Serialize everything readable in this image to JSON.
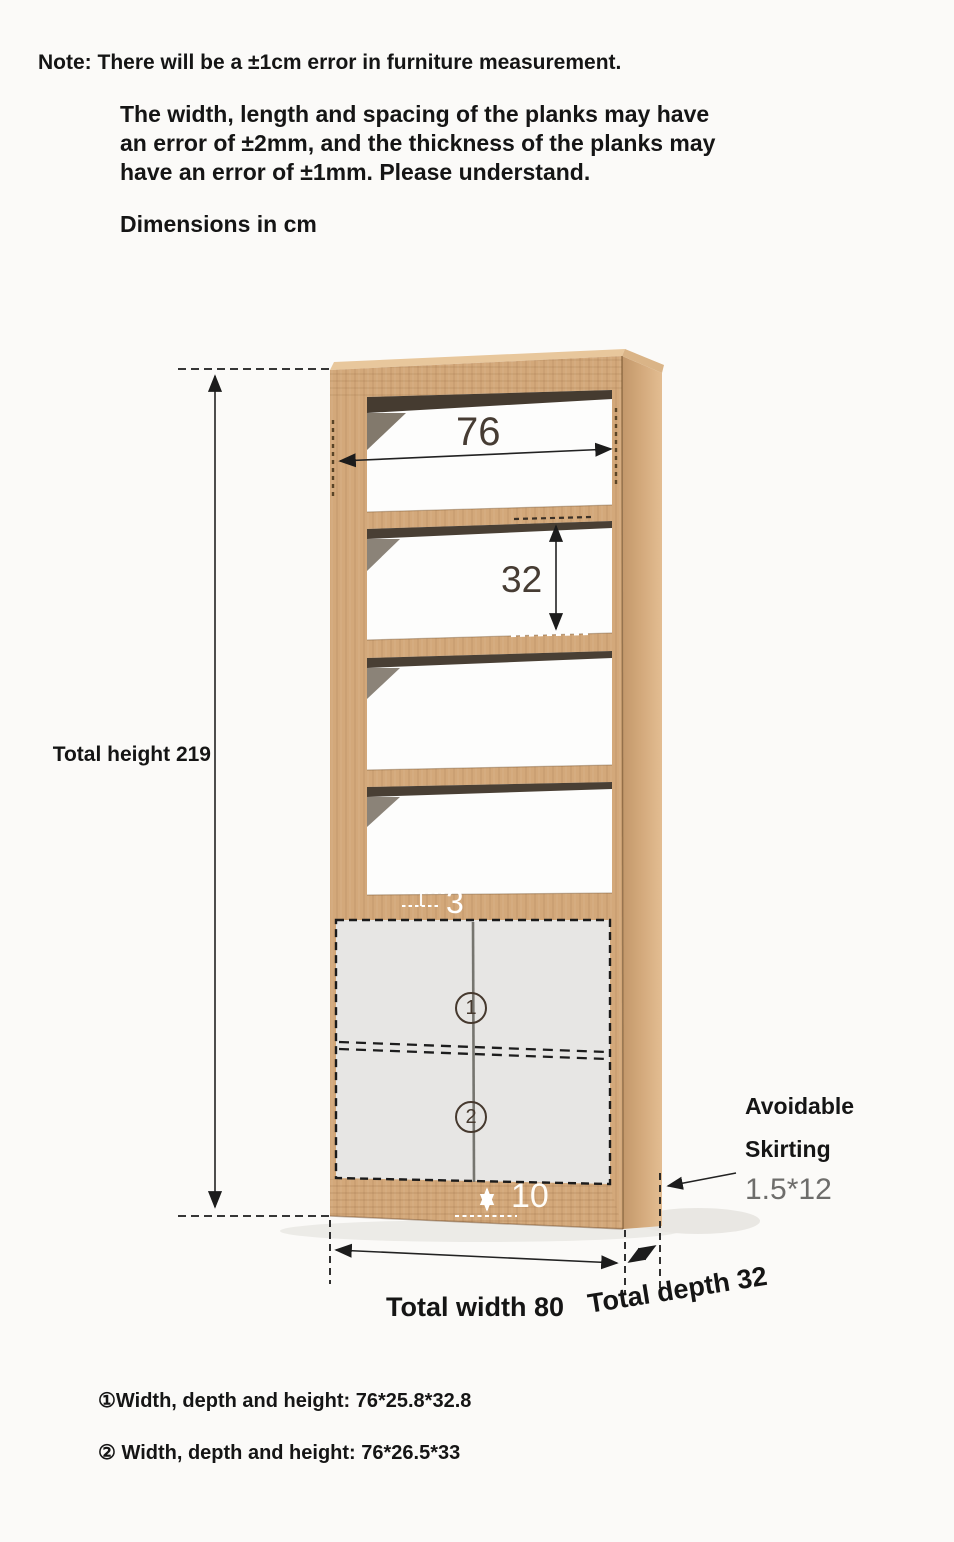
{
  "header": {
    "note": "Note: There will be a ±1cm error in furniture measurement.",
    "tolerance_lines": [
      "The width, length and spacing of the planks may have",
      "an error of ±2mm, and the thickness of the planks may",
      "have an error of ±1mm. Please understand."
    ],
    "units_label": "Dimensions in cm"
  },
  "diagram": {
    "total_height_label": "Total height 219",
    "inner_width": "76",
    "shelf_spacing": "32",
    "shelf_thickness": "3",
    "plinth_height": "10",
    "compartment_1": "1",
    "compartment_2": "2",
    "skirting_label_line1": "Avoidable",
    "skirting_label_line2": "Skirting",
    "skirting_size": "1.5*12",
    "total_width_label": "Total width 80",
    "total_depth_label": "Total depth 32"
  },
  "footnotes": {
    "compartment_1_dims": "①Width, depth and height: 76*25.8*32.8",
    "compartment_2_dims": "② Width, depth and height: 76*26.5*33"
  },
  "colors": {
    "wood_front": "#d3a87a",
    "wood_side": "#c79e72",
    "wood_top": "#e8c79c",
    "door_gray": "#e7e6e4",
    "shadow_dark": "#3a2b1c",
    "dimension_text_dark": "#463c33",
    "skirting_size_gray": "#6e6d6b",
    "white_label": "#ffffff"
  }
}
